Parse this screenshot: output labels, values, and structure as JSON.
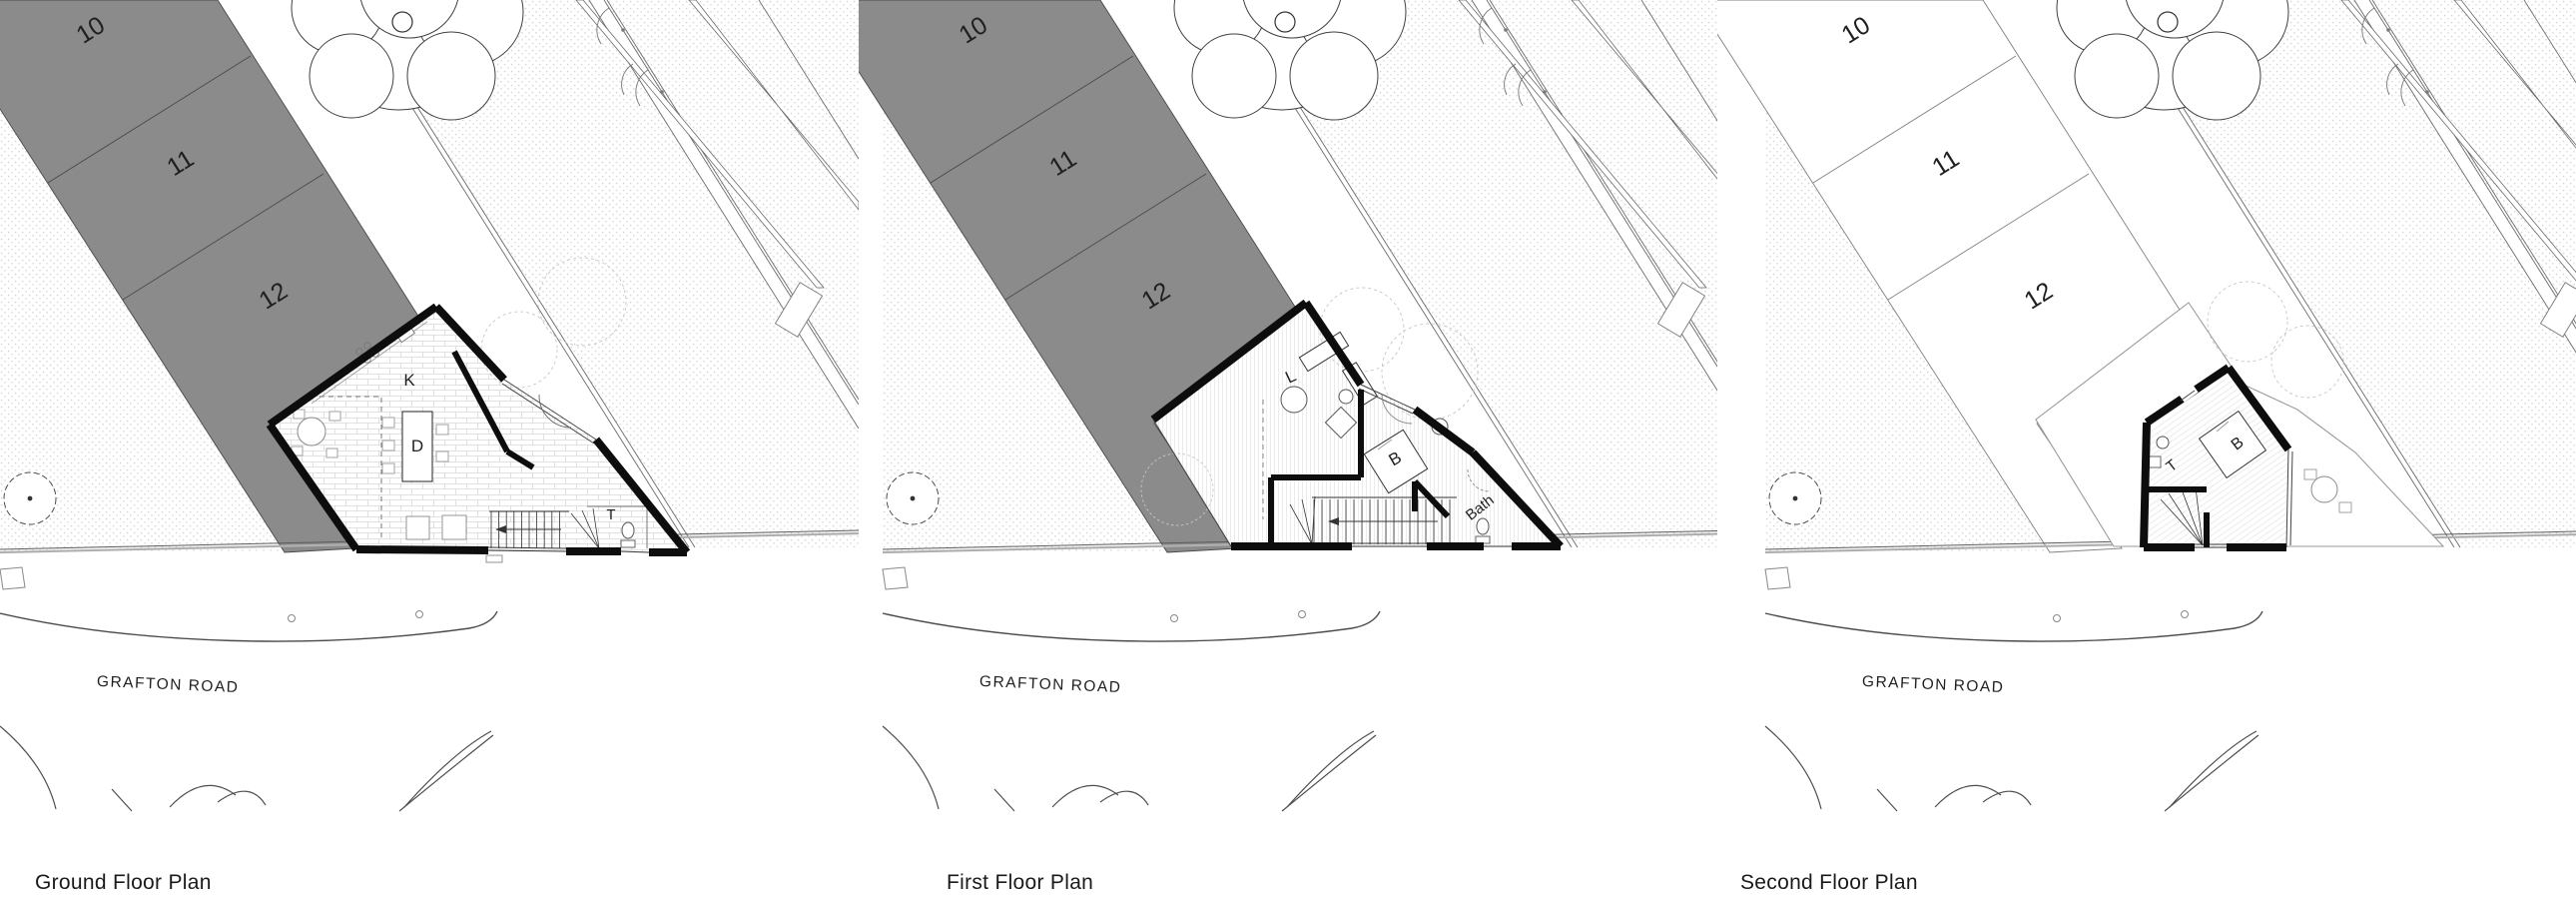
{
  "sheet": {
    "background": "#ffffff"
  },
  "panels": [
    {
      "id": "ground",
      "title": "Ground Floor Plan",
      "road_label": "GRAFTON ROAD",
      "plot_numbers": [
        "10",
        "11",
        "12"
      ],
      "rooms": [
        "K",
        "D",
        "T"
      ],
      "plot_band_shaded": true
    },
    {
      "id": "first",
      "title": "First Floor Plan",
      "road_label": "GRAFTON ROAD",
      "plot_numbers": [
        "10",
        "11",
        "12"
      ],
      "rooms": [
        "L",
        "B",
        "Bath"
      ],
      "plot_band_shaded": true
    },
    {
      "id": "second",
      "title": "Second Floor Plan",
      "road_label": "GRAFTON ROAD",
      "plot_numbers": [
        "10",
        "11",
        "12"
      ],
      "rooms": [
        "T",
        "B"
      ],
      "plot_band_shaded": false
    }
  ],
  "colors": {
    "plot_band_gray": "#8b8b8b",
    "wall": "#0d0d0d",
    "thin_line": "#555555",
    "context_line": "#6b6b6b",
    "light_line": "#999999",
    "stipple_dot": "#d4d4d4",
    "ghost_line": "#c6c6c6",
    "text": "#1f1f1f",
    "title_text": "#1a1a1a"
  }
}
